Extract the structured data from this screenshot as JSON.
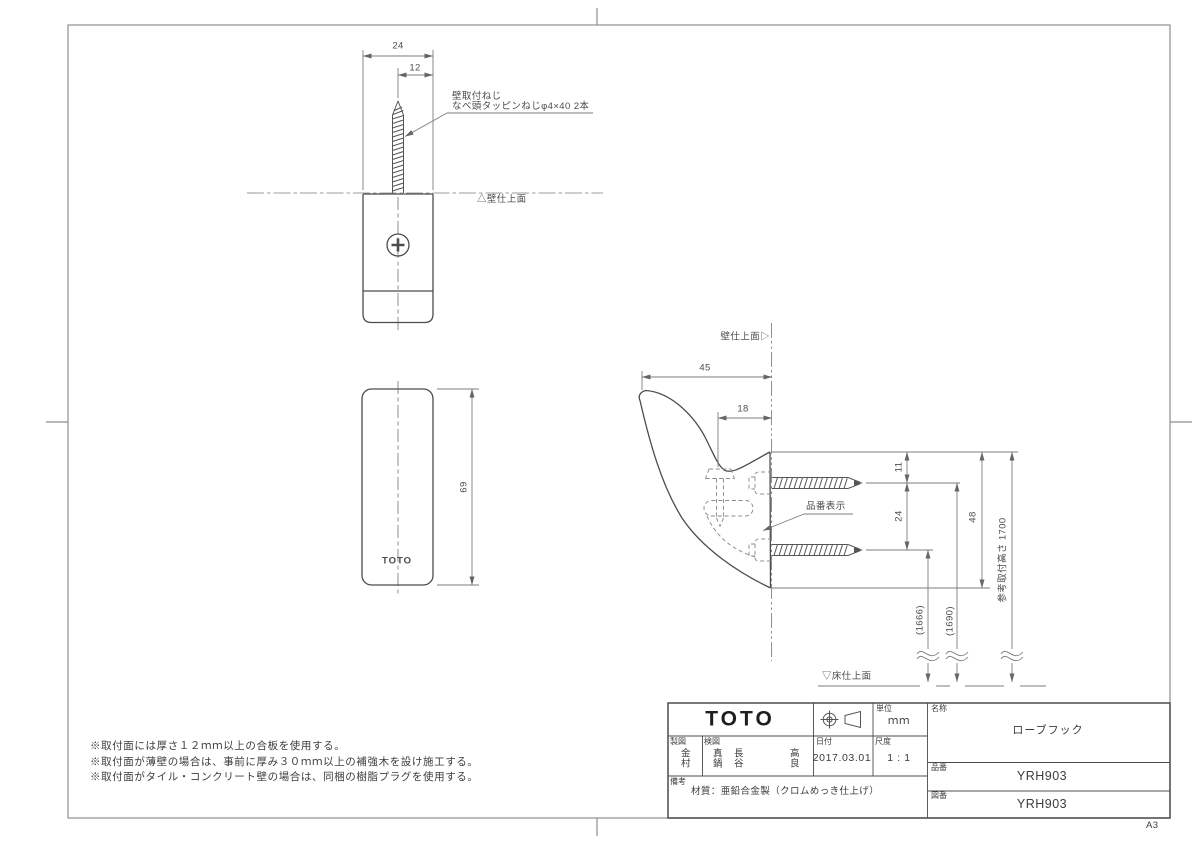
{
  "sheet": {
    "size_label": "A3"
  },
  "front_view": {
    "dim_width": "24",
    "dim_half": "12",
    "screw_note_line1": "壁取付ねじ",
    "screw_note_line2": "なべ頭タッピンねじφ4×40  2本",
    "wall_line_label": "△壁仕上面"
  },
  "bottom_view": {
    "logo": "TOTO",
    "dim_height": "69"
  },
  "side_view": {
    "wall_label": "壁仕上面▷",
    "dim_depth": "45",
    "dim_offset": "18",
    "dim_top_to_screw": "11",
    "dim_screw_pitch": "24",
    "dim_height": "48",
    "ref_height_label": "参考取付高さ 1700",
    "dim_floor_to_lower_screw": "(1666)",
    "dim_floor_to_upper_screw": "(1690)",
    "part_number_label": "品番表示",
    "floor_label": "▽床仕上面"
  },
  "notes": [
    "※取付面には厚さ１２ｍｍ以上の合板を使用する。",
    "※取付面が薄壁の場合は、事前に厚み３０ｍｍ以上の補強木を設け施工する。",
    "※取付面がタイル・コンクリート壁の場合は、同梱の樹脂プラグを使用する。"
  ],
  "title_block": {
    "logo": "TOTO",
    "unit_label": "単位",
    "unit_value": "ｍｍ",
    "drafter_label": "製図",
    "drafter_name": "金村",
    "checker_label": "検図",
    "checker_names": [
      "真鍋",
      "長谷",
      "高良"
    ],
    "date_label": "日付",
    "date_value": "2017.03.01",
    "scale_label": "尺度",
    "scale_value": "1 : 1",
    "remarks_label": "備考",
    "remarks_value": "材質：亜鉛合金製（クロムめっき仕上げ）",
    "name_label": "名称",
    "name_value": "ローブフック",
    "product_label": "品番",
    "product_value": "YRH903",
    "drawing_label": "図番",
    "drawing_value": "YRH903"
  }
}
